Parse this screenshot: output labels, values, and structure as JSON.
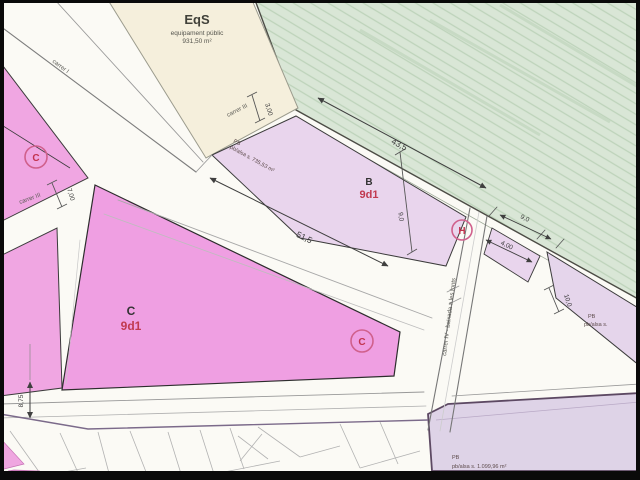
{
  "parcels": {
    "eqs": {
      "code": "EqS",
      "type": "equipament públic",
      "area": "931,50 m²"
    },
    "b": {
      "letter": "B",
      "zone": "9d1"
    },
    "c": {
      "letter": "C",
      "zone": "9d1"
    },
    "pb_b": {
      "line1": "PB",
      "line2": "pb/alsa s. 735,53 m²"
    },
    "pb_right": {
      "line1": "PB",
      "line2": "pb/alsa s."
    },
    "pb_bottom": {
      "line1": "PB",
      "line2": "pb/alsa s. 1.099,96 m²"
    }
  },
  "markers": {
    "c_left": "C",
    "c_center": "C",
    "h": "H"
  },
  "streets": {
    "carrer_i": "carrer I",
    "carrer_iii_upper": "carrer III",
    "carrer_iii_lower": "carrer III",
    "carrer_iv": "carrer IV - baixada a les fonts"
  },
  "dimensions": {
    "green_frontage": "43,5",
    "avenue_frontage": "51,5",
    "b_depth": "9,0",
    "carrer_iii_width": "3,00",
    "carrer_iii_lower_width": "7,00",
    "right_a": "9,0",
    "right_b": "4,00",
    "right_c": "10,0",
    "bottom_left": "8,75"
  },
  "colors": {
    "residential_pink": "#ef9fe2",
    "residential_lavender": "#e9d5ed",
    "public_green": "#d9e6d6",
    "facility_cream": "#f5efdc",
    "zone_code_red": "#c13a50",
    "marker_circle": "#d0608c"
  }
}
